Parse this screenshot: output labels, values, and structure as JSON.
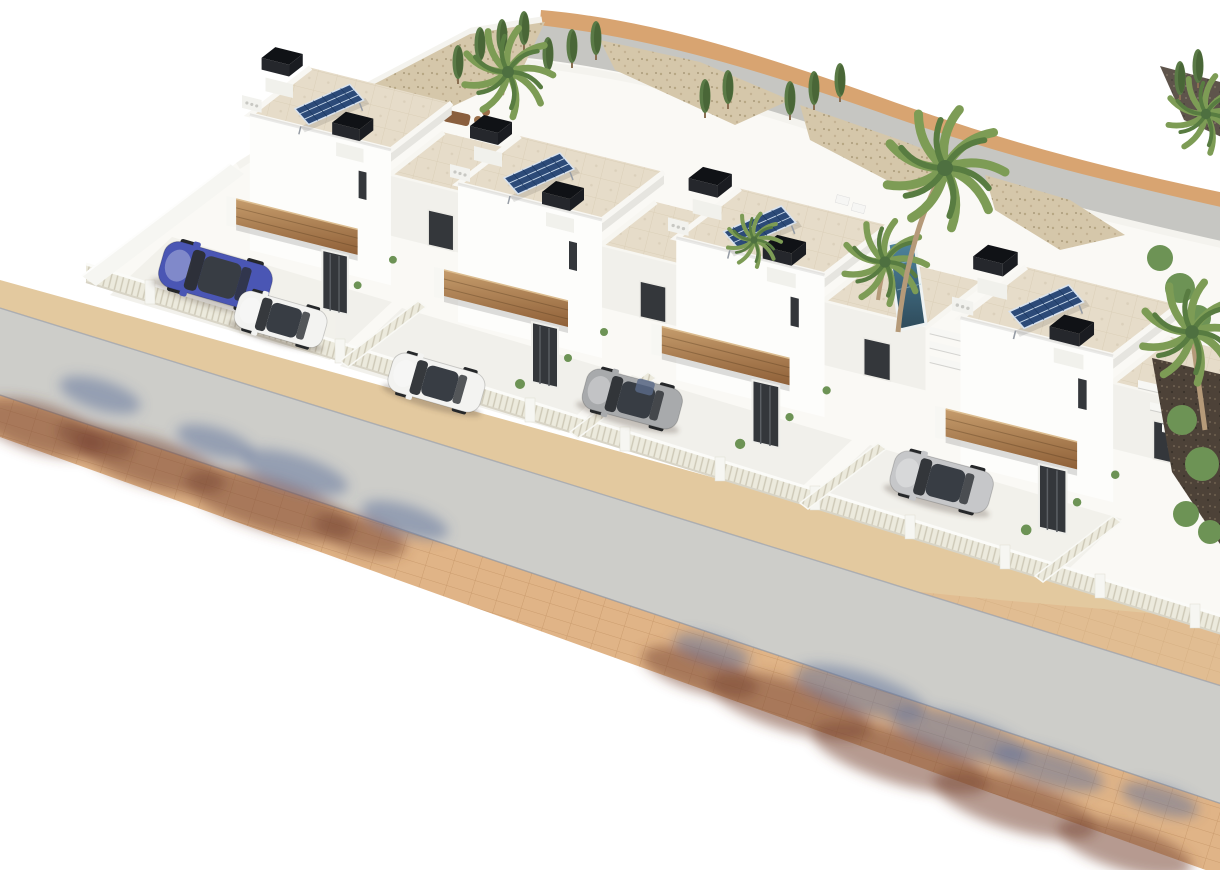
{
  "meta": {
    "title": "Aerial 3D architectural render of a new-build villa development",
    "description": "Bird's-eye 3D visualization of four identical modern white two-storey villas in a row along a street, each with travertine flat roofs, rooftop solar panels, black chimney caps, wooden balcony bands, private driveways with parked cars, slatted boundary fences, rear gravel gardens with cypress and palm trees, a small pool, a rear access road and a front street with terracotta paved sidewalks crossed by tree shadows"
  },
  "palette": {
    "bg": "#ffffff",
    "plotGround": "#faf9f5",
    "roadAsphalt": "#cdcdc9",
    "backRoad": "#c6c6c2",
    "dirtBand": "#d8a471",
    "sidewalkUpper": "#e3c99f",
    "sidewalkLower": "#e0b487",
    "curb": "#8e94a0",
    "roofTile": "#e6dcc9",
    "roofLine": "#d6c9b1",
    "parapet": "#f8f7f3",
    "wallLit": "#fdfdfb",
    "wallShade": "#f1f0eb",
    "wood": "#a87c50",
    "woodLight": "#c59c6c",
    "solarPanel": "#2c4a78",
    "solarCell": "#c7d8ea",
    "chimney": "#101216",
    "glassDark": "#34373b",
    "fence": "#eceadd",
    "fenceLine": "#cdc8b6",
    "gravelLight": "#d5c7aa",
    "gravelDark": "#4d4238",
    "cypress": "#5a7a46",
    "palmLight": "#7d9c55",
    "palmDark": "#587c41",
    "palmTrunk": "#b59a79",
    "pool": "#4f86a0",
    "poolDeep": "#2e4a5a",
    "bush": "#6d9355",
    "shadowBrown": "#7a4734",
    "shadowBlue": "#5e6f9b",
    "carBlue": "#4a56b4",
    "carWhite": "#f3f3f1",
    "carSilver": "#c6c7c9",
    "carGray": "#a8aaac"
  },
  "scene": {
    "villas": [
      {
        "id": "villa-1",
        "storeys": 2,
        "solar_panels": 1,
        "chimneys": 2,
        "cars": [
          {
            "type": "hatchback",
            "color": "blue"
          },
          {
            "type": "coupe",
            "color": "white"
          }
        ]
      },
      {
        "id": "villa-2",
        "storeys": 2,
        "solar_panels": 1,
        "chimneys": 2,
        "cars": [
          {
            "type": "hatchback",
            "color": "white"
          }
        ]
      },
      {
        "id": "villa-3",
        "storeys": 2,
        "solar_panels": 1,
        "chimneys": 2,
        "cars": [
          {
            "type": "sedan",
            "color": "gray"
          }
        ]
      },
      {
        "id": "villa-4",
        "storeys": 2,
        "solar_panels": 1,
        "chimneys": 2,
        "cars": [
          {
            "type": "suv",
            "color": "silver"
          }
        ]
      }
    ],
    "street": {
      "surface": "asphalt",
      "sidewalks": 2,
      "paving": "terracotta block paving",
      "tree_shadows": true
    },
    "rear_road": {
      "surface": "asphalt",
      "verge": "sand dirt band"
    },
    "landscape": {
      "palm_trees": 6,
      "cypress_trees": 14,
      "pool": 1,
      "gravel_beds": 5,
      "bushes": 7
    }
  }
}
